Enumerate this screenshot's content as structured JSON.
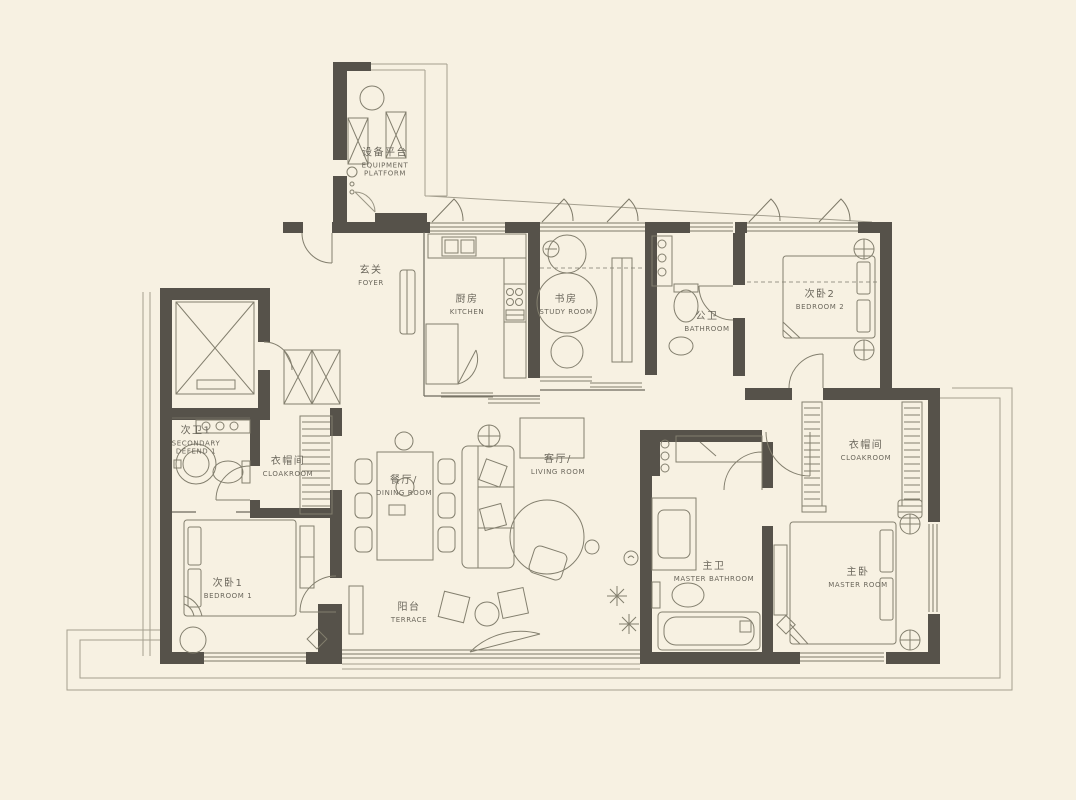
{
  "plan_title": "apartment-floor-plan",
  "colors": {
    "background": "#f7f1e2",
    "wall": "#56524a",
    "line": "#837f6e",
    "outline": "#a49f8f",
    "text": "#6b675c"
  },
  "rooms": [
    {
      "zh": "设备平台",
      "en": "EQUIPMENT PLATFORM"
    },
    {
      "zh": "玄关",
      "en": "FOYER"
    },
    {
      "zh": "厨房",
      "en": "KITCHEN"
    },
    {
      "zh": "书房",
      "en": "STUDY ROOM"
    },
    {
      "zh": "公卫",
      "en": "BATHROOM"
    },
    {
      "zh": "次卧2",
      "en": "BEDROOM 2"
    },
    {
      "zh": "次卫1",
      "en": "SECONDARY DEFEND 1"
    },
    {
      "zh": "衣帽间",
      "en": "CLOAKROOM"
    },
    {
      "zh": "餐厅/",
      "en": "DINING ROOM"
    },
    {
      "zh": "客厅/",
      "en": "LIVING ROOM"
    },
    {
      "zh": "次卧1",
      "en": "BEDROOM 1"
    },
    {
      "zh": "阳台",
      "en": "TERRACE"
    },
    {
      "zh": "主卫",
      "en": "MASTER BATHROOM"
    },
    {
      "zh": "主卧",
      "en": "MASTER ROOM"
    },
    {
      "zh": "衣帽间",
      "en": "CLOAKROOM"
    }
  ]
}
